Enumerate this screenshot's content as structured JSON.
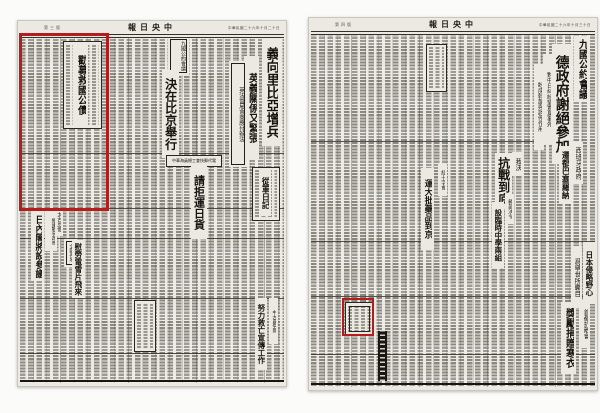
{
  "paper": {
    "name": "中央日報",
    "title_display": "報日央中"
  },
  "annotation": {
    "color": "#b71c1c"
  },
  "left_page": {
    "masthead": {
      "page_label": "第三版",
      "title_display": "報日央中",
      "date": "中華民國二十六年十月二十日"
    },
    "headlines": {
      "bond_ad": "勸募救國公債",
      "nine_power_kicker": "九國公約會議",
      "brussels": "決在比京舉行",
      "italy_libya": "義向里比亞增兵",
      "anglo_italian": "英義關係又緊張",
      "anglo_french_sub": "英法當局會商應付辦法",
      "seamen_union": "中華海員總工會快郵代電",
      "refuse_cargo": "請拒運日貨",
      "war_diary": "從軍日記",
      "taikoo": "太古怠慢",
      "japan_cabinet_kicker": "擁護戰爭政策",
      "japan_cabinet": "日內閣將設參議",
      "nationwide_kicker": "全國各地",
      "telegrams": "慰勞電雪片飛來",
      "univ_team_kicker": "中大農學團",
      "propaganda": "努力救亡宣傳工作"
    }
  },
  "right_page": {
    "masthead": {
      "page_label": "第四版",
      "title_display": "報日央中",
      "date": "中華民國二十六年十月三十日"
    },
    "headlines": {
      "nine_power_kicker": "九國公約會議",
      "germany_declines": "德政府謝絕參加",
      "sub1": "對中日糾紛望置身事外",
      "sub2": "盼成斡旋與調停作用",
      "spain_kicker": "西班牙政府",
      "spain_move": "遷都巴塞羅納",
      "resist_kicker": "我決",
      "resist": "抗戰到底",
      "redcross_kicker": "紅十字會",
      "medicine": "運大批藥品到京",
      "moe_kicker": "敎部決令",
      "schools": "設臨時中學兩組",
      "japan_ambition": "日本侵略野心",
      "world_watch": "爲舉世所矚目",
      "capital_kicker": "首都抗敵會",
      "winter_clothes": "獎勵捐贈寒衣"
    }
  }
}
